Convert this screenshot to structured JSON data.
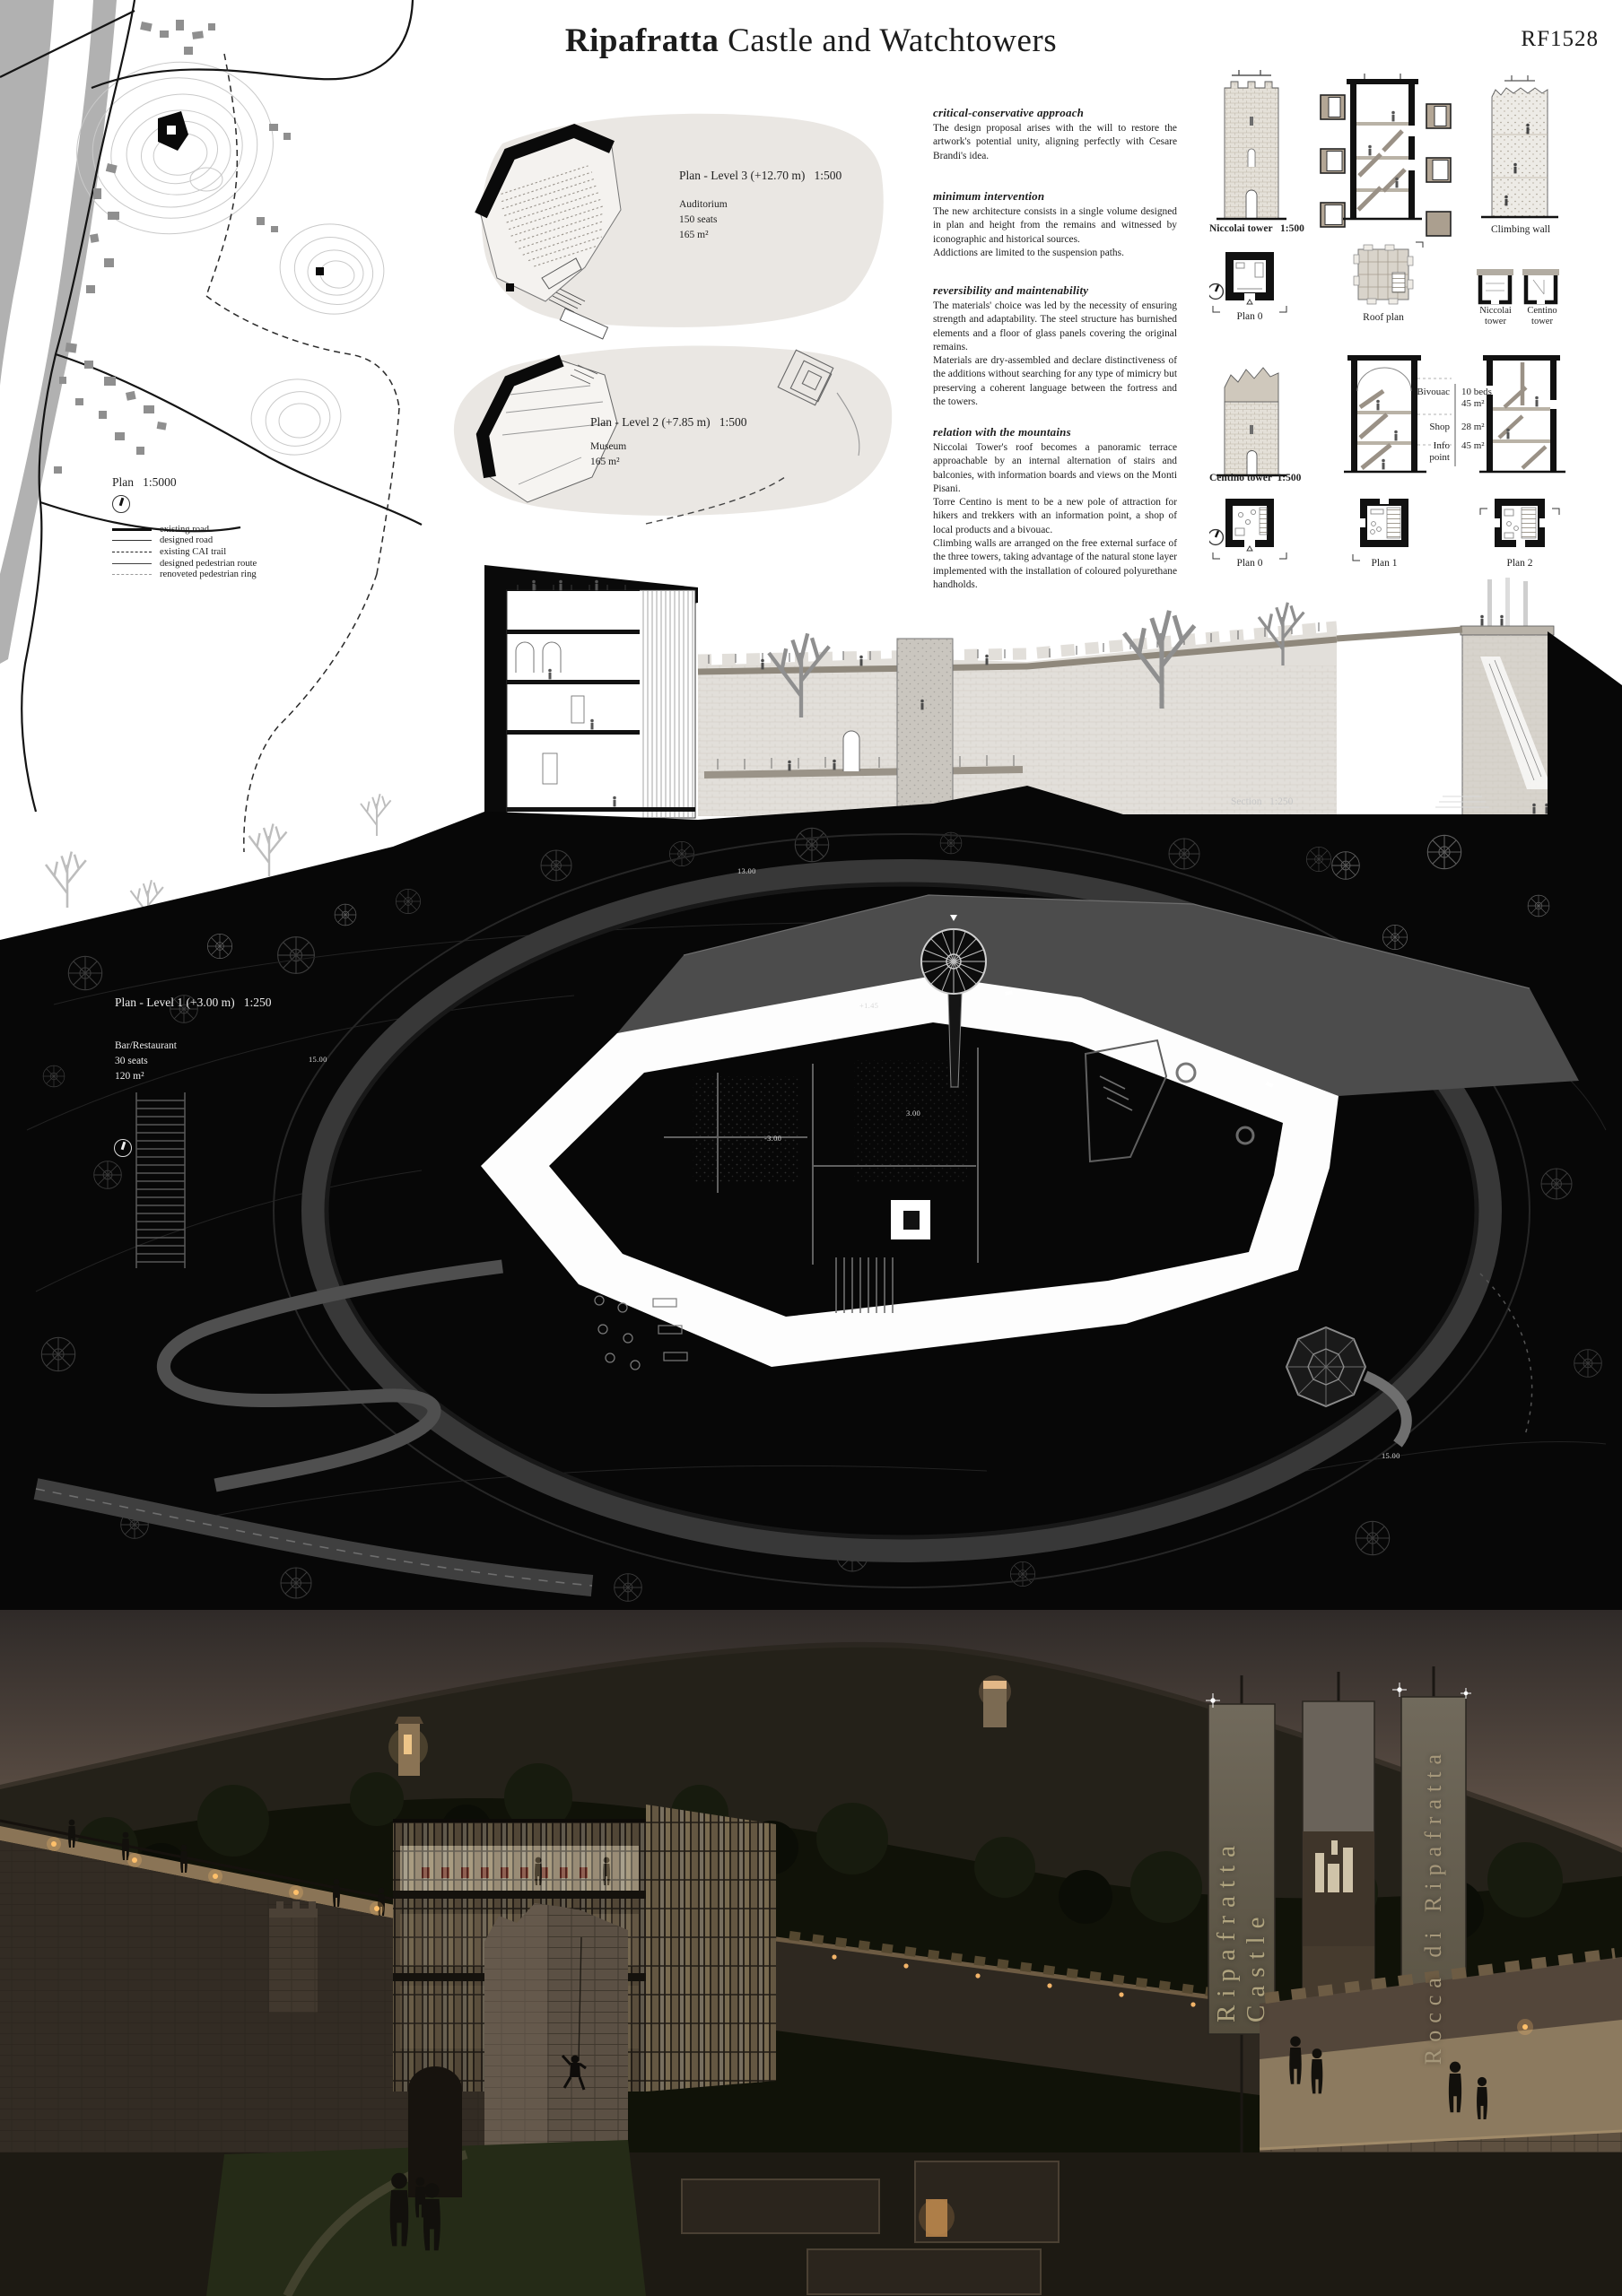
{
  "header": {
    "title_bold": "Ripafratta",
    "title_rest": " Castle and Watchtowers",
    "code": "RF1528"
  },
  "site_map": {
    "scale_label": "Plan   1:5000",
    "legend": [
      {
        "label": "existing road"
      },
      {
        "label": "designed road"
      },
      {
        "label": "existing CAI trail"
      },
      {
        "label": "designed pedestrian route"
      },
      {
        "label": "renoveted pedestrian ring"
      }
    ]
  },
  "plans": {
    "level3": {
      "title": "Plan - Level 3 (+12.70 m)   1:500",
      "line1": "Auditorium",
      "line2": "150 seats",
      "line3": "165 m²"
    },
    "level2": {
      "title": "Plan - Level 2 (+7.85 m)   1:500",
      "line1": "Museum",
      "line2": "165 m²"
    },
    "level1": {
      "title": "Plan - Level 1 (+3.00 m)   1:250",
      "line1": "Bar/Restaurant",
      "line2": "30 seats",
      "line3": "120 m²"
    }
  },
  "essay": {
    "sections": [
      {
        "heading": "critical-conservative approach",
        "body": "The design proposal arises with the will to restore the artwork's potential unity, aligning perfectly with Cesare Brandi's idea."
      },
      {
        "heading": "minimum intervention",
        "body": "The new architecture consists in a single volume designed in plan and height from the remains and witnessed by iconographic and historical sources.\nAddictions are limited to the suspension paths."
      },
      {
        "heading": "reversibility and maintenability",
        "body": "The materials' choice was led by the necessity of ensuring strength and adaptability. The steel structure has burnished elements and a floor of glass panels covering the original remains.\nMaterials are dry-assembled and declare distinctiveness of the additions without searching for any type of mimicry but preserving a coherent language between the fortress and the towers."
      },
      {
        "heading": "relation with the mountains",
        "body": "Niccolai Tower's roof becomes a panoramic terrace approachable by an internal alternation of stairs and balconies, with information boards and views on the Monti Pisani.\nTorre Centino is ment to be a new pole of attraction for hikers and trekkers with an information point, a shop of local products and a bivouac.\nClimbing walls are arranged on the free external surface of the three towers, taking advantage of the natural stone layer implemented with the installation of coloured polyurethane handholds."
      }
    ]
  },
  "towers": {
    "niccolai_label": "Niccolai tower   1:500",
    "climbing_label": "Climbing wall",
    "plan0_label": "Plan 0",
    "roof_label": "Roof plan",
    "niccolai_small": "Niccolai\ntower",
    "centino_small": "Centino\ntower",
    "centino_label": "Centino tower  1:500",
    "program": [
      {
        "name": "Bivouac",
        "value": "10 beds\n45 m²"
      },
      {
        "name": "Shop",
        "value": "28 m²"
      },
      {
        "name": "Info\npoint",
        "value": "45 m²"
      }
    ],
    "plan0b_label": "Plan 0",
    "plan1_label": "Plan 1",
    "plan2_label": "Plan 2"
  },
  "section": {
    "label": "Section   1:250"
  },
  "site_plan": {
    "spots": [
      "13.00",
      "15.00",
      "+1.45",
      "3.00",
      "-3.00",
      "15.00"
    ]
  },
  "render": {
    "banner_left": "Ripafratta Castle",
    "banner_right": "Rocca di Ripafratta"
  }
}
